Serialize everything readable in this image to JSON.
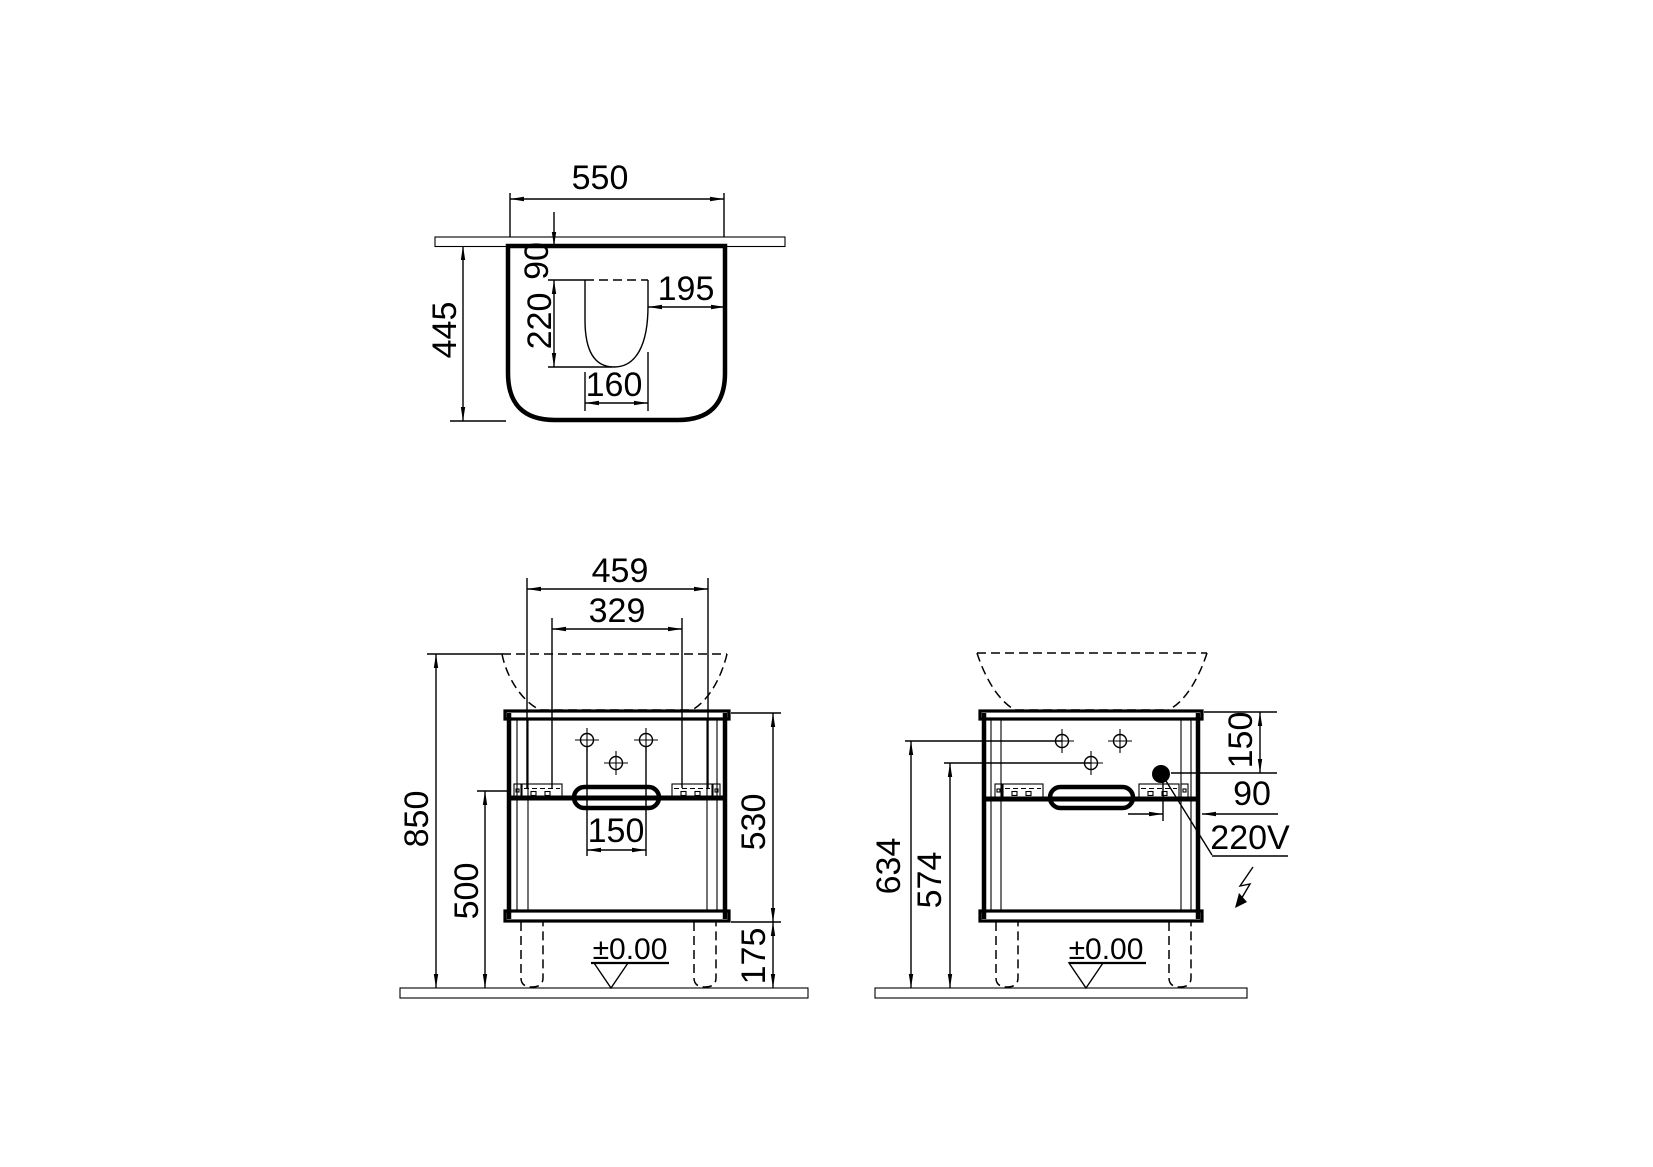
{
  "views": {
    "top": {
      "width": "550",
      "depth": "445",
      "cutout_back_offset": "90",
      "cutout_depth": "220",
      "cutout_side_offset": "195",
      "cutout_width": "160"
    },
    "front": {
      "basin_width": "459",
      "mount_span": "329",
      "total_height": "850",
      "rail_height": "500",
      "cabinet_height": "530",
      "leg_height": "175",
      "handle_width": "150",
      "floor_datum": "±0.00"
    },
    "side": {
      "upper_hole_height": "634",
      "lower_hole_height": "574",
      "socket_top_offset": "150",
      "socket_side_offset": "90",
      "socket_voltage": "220V",
      "floor_datum": "±0.00"
    }
  }
}
